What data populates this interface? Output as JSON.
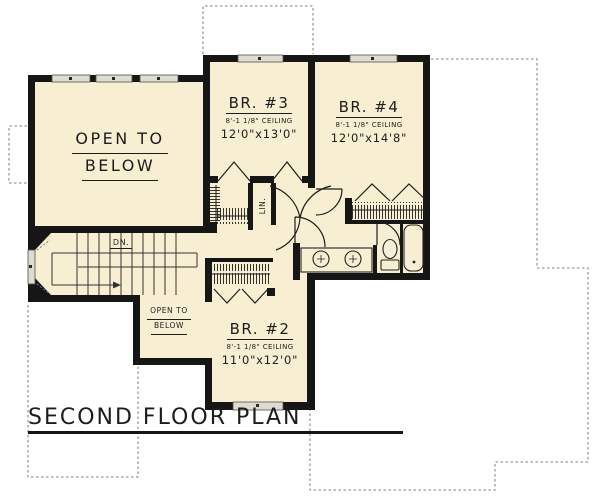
{
  "meta": {
    "plan_title": "SECOND FLOOR PLAN"
  },
  "colors": {
    "floor_fill": "#f8efd2",
    "wall": "#161616",
    "dashed_outline": "#999999",
    "window_fill": "#dedbd0",
    "text": "#1c1c1c"
  },
  "rooms": [
    {
      "id": "open-to-below-main",
      "line1": "OPEN TO",
      "line2": "BELOW"
    },
    {
      "id": "bedroom-3",
      "name": "BR. #3",
      "ceiling": "8'-1 1/8\" CEILING",
      "dims": "12'0\"x13'0\""
    },
    {
      "id": "bedroom-4",
      "name": "BR. #4",
      "ceiling": "8'-1 1/8\" CEILING",
      "dims": "12'0\"x14'8\""
    },
    {
      "id": "bedroom-2",
      "name": "BR. #2",
      "ceiling": "8'-1 1/8\" CEILING",
      "dims": "11'0\"x12'0\""
    },
    {
      "id": "open-to-below-small",
      "line1": "OPEN TO",
      "line2": "BELOW"
    }
  ],
  "labels": {
    "stairs_down": "DN.",
    "linen_closet": "LIN."
  }
}
